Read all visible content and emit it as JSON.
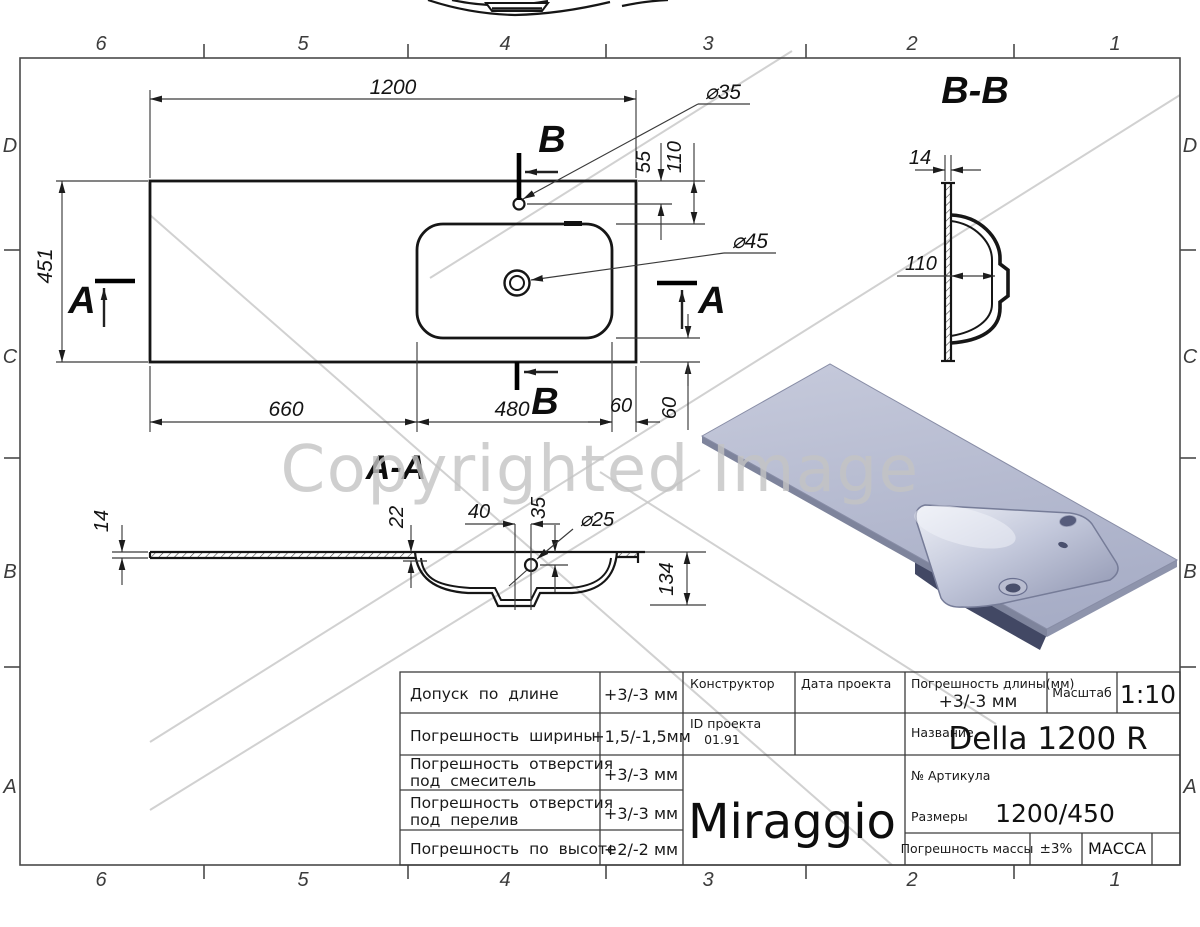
{
  "watermark": {
    "text": "Copyrighted Image"
  },
  "frame": {
    "cols": [
      "6",
      "5",
      "4",
      "3",
      "2",
      "1"
    ],
    "rows": [
      "D",
      "C",
      "B",
      "A"
    ]
  },
  "plan": {
    "dim_width": "1200",
    "dim_height": "451",
    "dim_left": "660",
    "dim_basin": "480",
    "dim_right": "60",
    "dim_edge": "60",
    "dim_faucet": "55",
    "dim_basin_top": "110",
    "faucet_dia": "⌀35",
    "drain_dia": "⌀45",
    "cut_a": "A",
    "cut_b": "B"
  },
  "section_bb": {
    "title": "B-B",
    "dim_wall": "14",
    "dim_depth": "110"
  },
  "section_aa": {
    "title": "A-A",
    "dim_slab": "14",
    "dim_rim": "22",
    "dim_drain_x": "40",
    "dim_drain_y": "35",
    "drain_dia": "⌀25",
    "dim_height": "134"
  },
  "title_block": {
    "tolerances": [
      {
        "lines": [
          "Допуск по длине",
          ""
        ],
        "value": "+3/-3 мм"
      },
      {
        "lines": [
          "Погрешность ширины",
          ""
        ],
        "value": "+1,5/-1,5мм"
      },
      {
        "lines": [
          "Погрешность отверстия",
          "под смеситель"
        ],
        "value": "+3/-3 мм"
      },
      {
        "lines": [
          "Погрешность отверстия",
          "под перелив"
        ],
        "value": "+3/-3 мм"
      },
      {
        "lines": [
          "Погрешность по высоте",
          ""
        ],
        "value": "+2/-2 мм"
      }
    ],
    "constructor_label": "Конструктор",
    "date_label": "Дата проекта",
    "project_id_label": "ID проекта",
    "project_id_value": "01.91",
    "brand": "Miraggio",
    "len_tol_label": "Погрешность длины(мм)",
    "len_tol_value": "+3/-3 мм",
    "scale_label": "Масштаб",
    "scale_value": "1:10",
    "name_label": "Название",
    "name_value": "Della 1200 R",
    "article_label": "№ Артикула",
    "size_label": "Размеры",
    "size_value": "1200/450",
    "mass_tol_label": "Погрешность массы",
    "mass_tol_value": "±3%",
    "mass_label": "МАССА"
  }
}
